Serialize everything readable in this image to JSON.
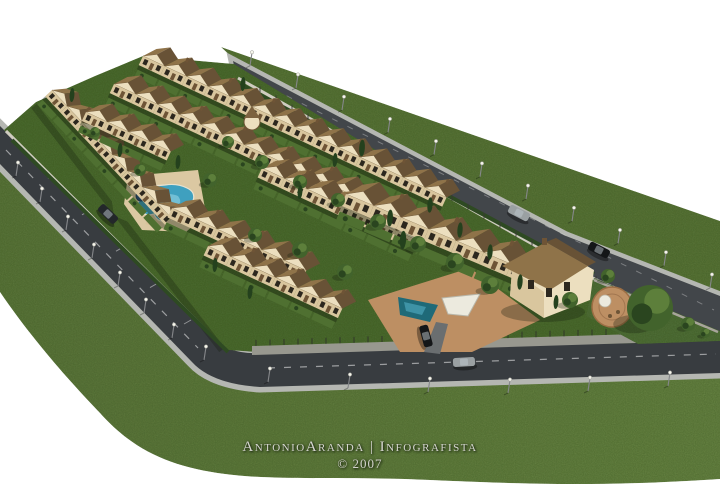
{
  "credit": {
    "line1": "AntonioAranda | Infografista",
    "line2": "© 2007"
  },
  "scene": {
    "kind": "aerial 3D architectural rendering",
    "subject": "Wedge-shaped residential townhouse development bounded by perimeter streets, with a communal free-form swimming pool, a second plunge pool at the entrance plaza, private gardens, street lamps, parked cars and surrounding lawn on a white background",
    "colors": {
      "background": "#ffffff",
      "grass_field": "#617c3e",
      "grass_field_light": "#6d8a46",
      "grass_strip": "#5e7a3b",
      "garden": "#4f7031",
      "asphalt": "#42464a",
      "asphalt_dark": "#383c40",
      "sidewalk": "#b5b7b2",
      "stone_wall": "#98988f",
      "boundary_wall": "#cfccc0",
      "hedge": "#2e4a22",
      "roof_light": "#8f7349",
      "roof_dark": "#685236",
      "facade": "#ecdfbf",
      "facade_shade": "#d9c69e",
      "trim": "#6e5436",
      "window": "#2c271e",
      "pool_water": "#3fa0bf",
      "pool_water_light": "#7fc7db",
      "pool_water_2": "#1f6a78",
      "pool_deck": "#dbc8a2",
      "terrace": "#bd8f63",
      "tree": "#42632c",
      "tree_dark": "#2a451f",
      "tree_light": "#5d7f3b",
      "cypress": "#24411d",
      "car_dark": "#23272a",
      "car_black": "#141618",
      "car_silver": "#9aa0a2",
      "lamp_head": "#f6f6ec",
      "umbrella": "#2b4f7e",
      "canopy": "#eceade",
      "text": "#d6d6d0"
    },
    "inventory": {
      "townhouse_rows": 8,
      "townhouse_units_approx": 64,
      "detached_chalet": 1,
      "circular_turret": 1,
      "swimming_pools": 2,
      "parked_cars": 5,
      "street_lamps": 22,
      "perimeter_streets": 3
    }
  }
}
